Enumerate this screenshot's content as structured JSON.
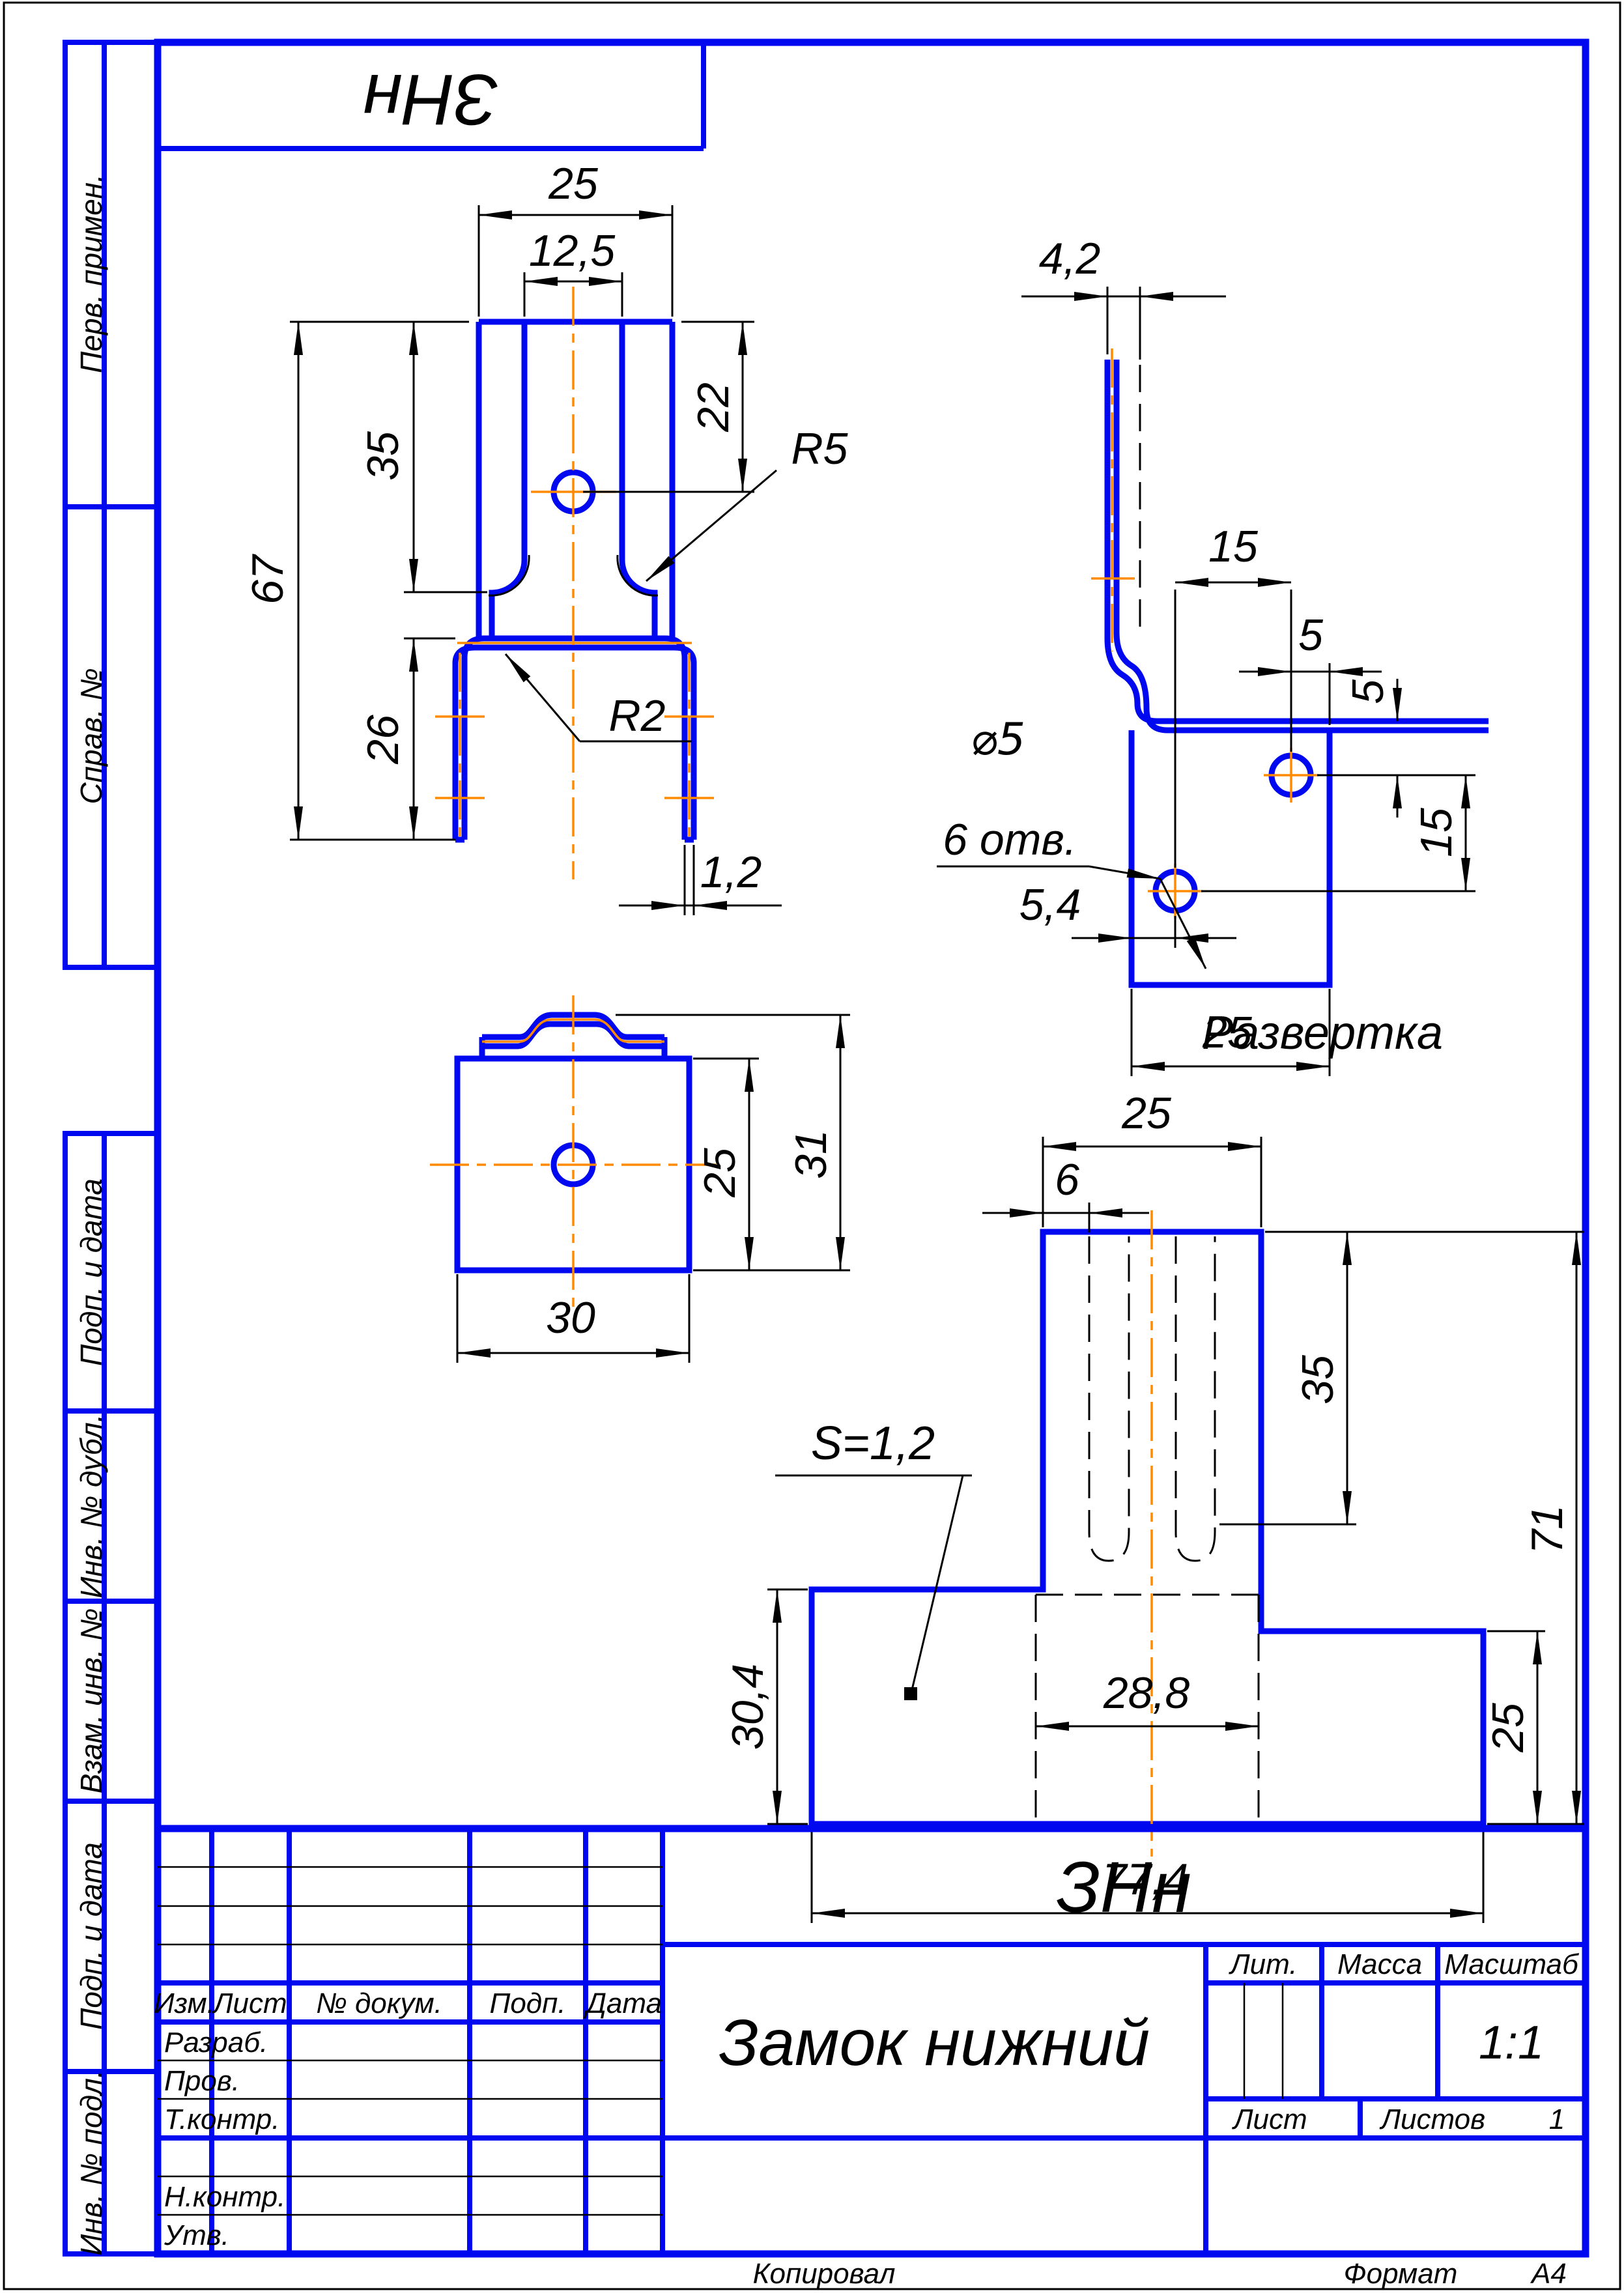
{
  "sheet": {
    "copied_label": "Копировал",
    "format_label": "Формат",
    "format_value": "А4"
  },
  "sidebar": {
    "items": [
      {
        "label": "Перв. примен."
      },
      {
        "label": "Справ. №"
      },
      {
        "label": "Подп. и дата"
      },
      {
        "label": "Инв. № дубл."
      },
      {
        "label": "Взам. инв. №"
      },
      {
        "label": "Подп. и дата"
      },
      {
        "label": "Инв. № подл."
      }
    ]
  },
  "stamp": {
    "doc_code_rotated": "ЗНн",
    "doc_code": "ЗНн",
    "part_name": "Замок нижний",
    "col_izm": "Изм.",
    "col_list": "Лист",
    "col_doc": "№ докум.",
    "col_podp": "Подп.",
    "col_data": "Дата",
    "row_razrab": "Разраб.",
    "row_prov": "Пров.",
    "row_tkontr": "Т.контр.",
    "row_nkontr": "Н.контр.",
    "row_utv": "Утв.",
    "lit_label": "Лит.",
    "massa_label": "Масса",
    "masshtab_label": "Масштаб",
    "scale_value": "1:1",
    "list_label": "Лист",
    "listov_label": "Листов",
    "listov_value": "1"
  },
  "views": {
    "front": {
      "d_width": "25",
      "d_slot": "12,5",
      "d_hole": "22",
      "d_slot_depth": "35",
      "d_height": "67",
      "d_leg": "26",
      "r_slot": "R5",
      "r_bend": "R2",
      "d_thk": "1,2"
    },
    "side": {
      "d_fold": "4,2",
      "d_hole_x": "15",
      "d_edge_x": "5",
      "d_edge_y": "5",
      "d_hole_y": "15",
      "d_width": "25",
      "d_hole_left": "5,4",
      "hole_dia": "⌀5",
      "hole_count": "6 отв."
    },
    "top": {
      "d_inner": "25",
      "d_total": "31",
      "d_width": "30"
    },
    "flat": {
      "title": "Развертка",
      "d_stem": "25",
      "d_slot": "6",
      "d_depth": "35",
      "d_total_h": "71",
      "d_left_h": "30,4",
      "d_right_h": "25",
      "d_between": "28,8",
      "d_total_w": "77,4",
      "thickness": "S=1,2"
    }
  }
}
